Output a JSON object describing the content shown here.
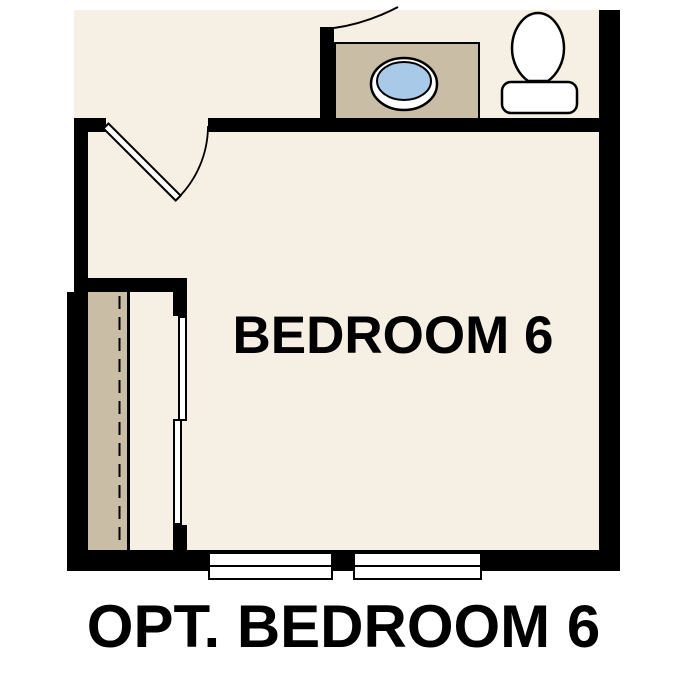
{
  "plan": {
    "room_label": "BEDROOM 6",
    "caption": "OPT. BEDROOM 6",
    "fixtures": [
      "hinged-entry-door-with-swing",
      "partial-door-swing-arc-top",
      "vanity-counter",
      "oval-sink-basin",
      "toilet",
      "closet-shelf",
      "closet-rod-dashed-line",
      "bypass-sliding-closet-doors",
      "window",
      "window"
    ]
  },
  "colors": {
    "background": "#ffffff",
    "floor": "#f6efe3",
    "wall": "#000000",
    "millwork": "#c9bda6",
    "sink_basin": "#a9c9e9",
    "text": "#000000"
  }
}
